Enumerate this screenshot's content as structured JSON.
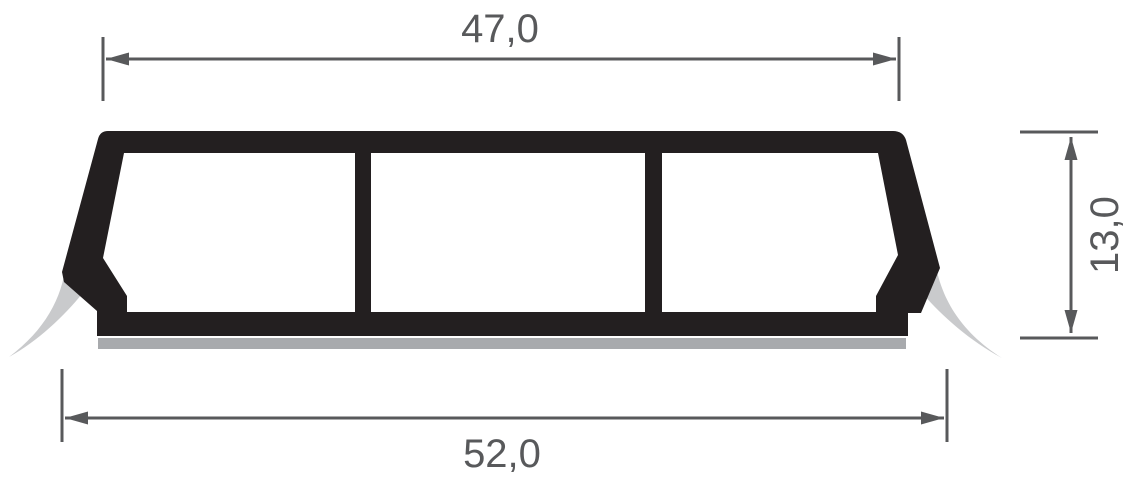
{
  "drawing": {
    "type": "profile-cross-section-technical-drawing",
    "profile": {
      "chambers": 3,
      "side_lips": 2,
      "base_strip": true
    },
    "dimensions": {
      "top_width": {
        "label": "47,0",
        "value": 47.0
      },
      "overall_width": {
        "label": "52,0",
        "value": 52.0
      },
      "height": {
        "label": "13,0",
        "value": 13.0
      }
    }
  },
  "colors": {
    "ink": "#231f20",
    "lip_gray": "#c9cacc",
    "strip_gray": "#a8aaad",
    "dim_gray": "#58595b",
    "background": "#ffffff"
  }
}
